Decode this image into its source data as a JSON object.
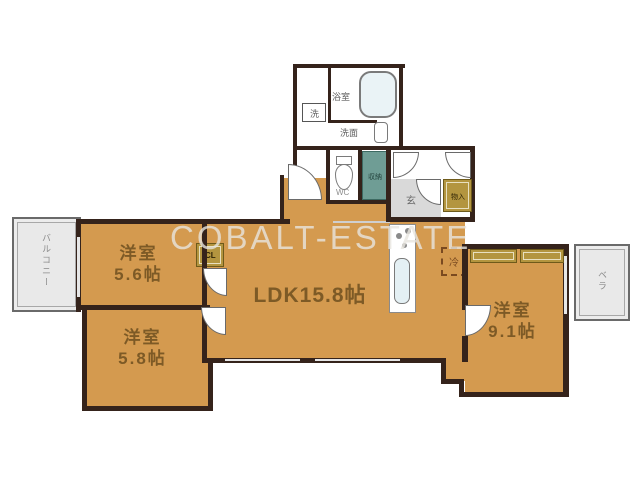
{
  "plan": {
    "watermark": "COBALT-ESTATE",
    "rooms": {
      "ldk": {
        "label": "LDK15.8帖"
      },
      "bedroom1": {
        "name": "洋室",
        "size": "5.6帖"
      },
      "bedroom2": {
        "name": "洋室",
        "size": "5.8帖"
      },
      "bedroom3": {
        "name": "洋室",
        "size": "9.1帖"
      },
      "balcony_left": {
        "label": "バルコニー"
      },
      "balcony_right": {
        "label": "ベラ"
      },
      "bath": {
        "label": "浴室"
      },
      "washroom": {
        "label": "洗面"
      },
      "washer": {
        "label": "洗"
      },
      "wc": {
        "label": "WC"
      },
      "storage": {
        "label": "収納"
      },
      "entrance": {
        "label": "玄"
      },
      "hall_storage": {
        "label": "物入"
      },
      "closet": {
        "label": "CL"
      },
      "fridge": {
        "label": "冷"
      }
    },
    "colors": {
      "room_fill": "#d49a4f",
      "wall": "#35231b",
      "storage_teal": "#6f9d95",
      "closet_olive": "#b3953f",
      "balcony_gray": "#ececec",
      "entrance_gray": "#d9d9d9",
      "label_brown": "#7d5a26"
    }
  }
}
